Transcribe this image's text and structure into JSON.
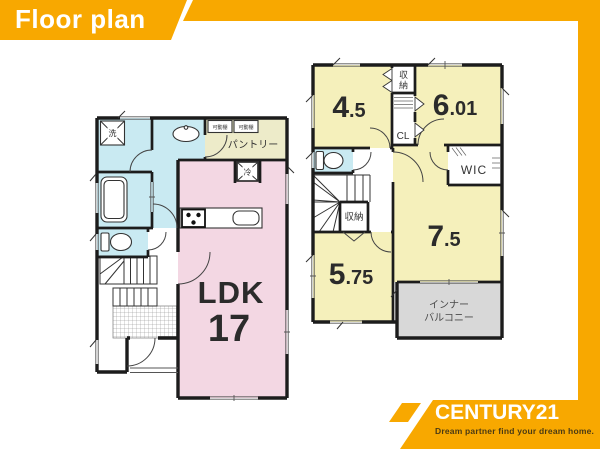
{
  "banner": {
    "title": "Floor plan"
  },
  "brand": {
    "name": "CENTURY21",
    "tagline": "Dream partner find your dream home."
  },
  "colors": {
    "gold": "#F8A800",
    "room_pink": "#F3D7E3",
    "room_yellow": "#F5F0BB",
    "room_blue": "#C9EAF2",
    "room_cream": "#EDEBC9",
    "balcony_gray": "#D8D8D8",
    "wall": "#1C1C1C",
    "tagline_text": "#4A3A14"
  },
  "floor1": {
    "ldk": {
      "label": "LDK",
      "size": "17"
    },
    "pantry": "パントリー",
    "shelf_left": "可動棚",
    "shelf_right": "可動棚",
    "fridge": "冷",
    "washer": "洗"
  },
  "floor2": {
    "rooms": {
      "r45": {
        "i": "4",
        "d": ".5"
      },
      "r601": {
        "i": "6",
        "d": ".01"
      },
      "r75": {
        "i": "7",
        "d": ".5"
      },
      "r575": {
        "i": "5",
        "d": ".75"
      }
    },
    "closet_top": {
      "c1": "収",
      "c2": "納"
    },
    "closet_cl": "CL",
    "wic": "WIC",
    "closet_stairs": "収納",
    "balcony_line1": "インナー",
    "balcony_line2": "バルコニー"
  }
}
